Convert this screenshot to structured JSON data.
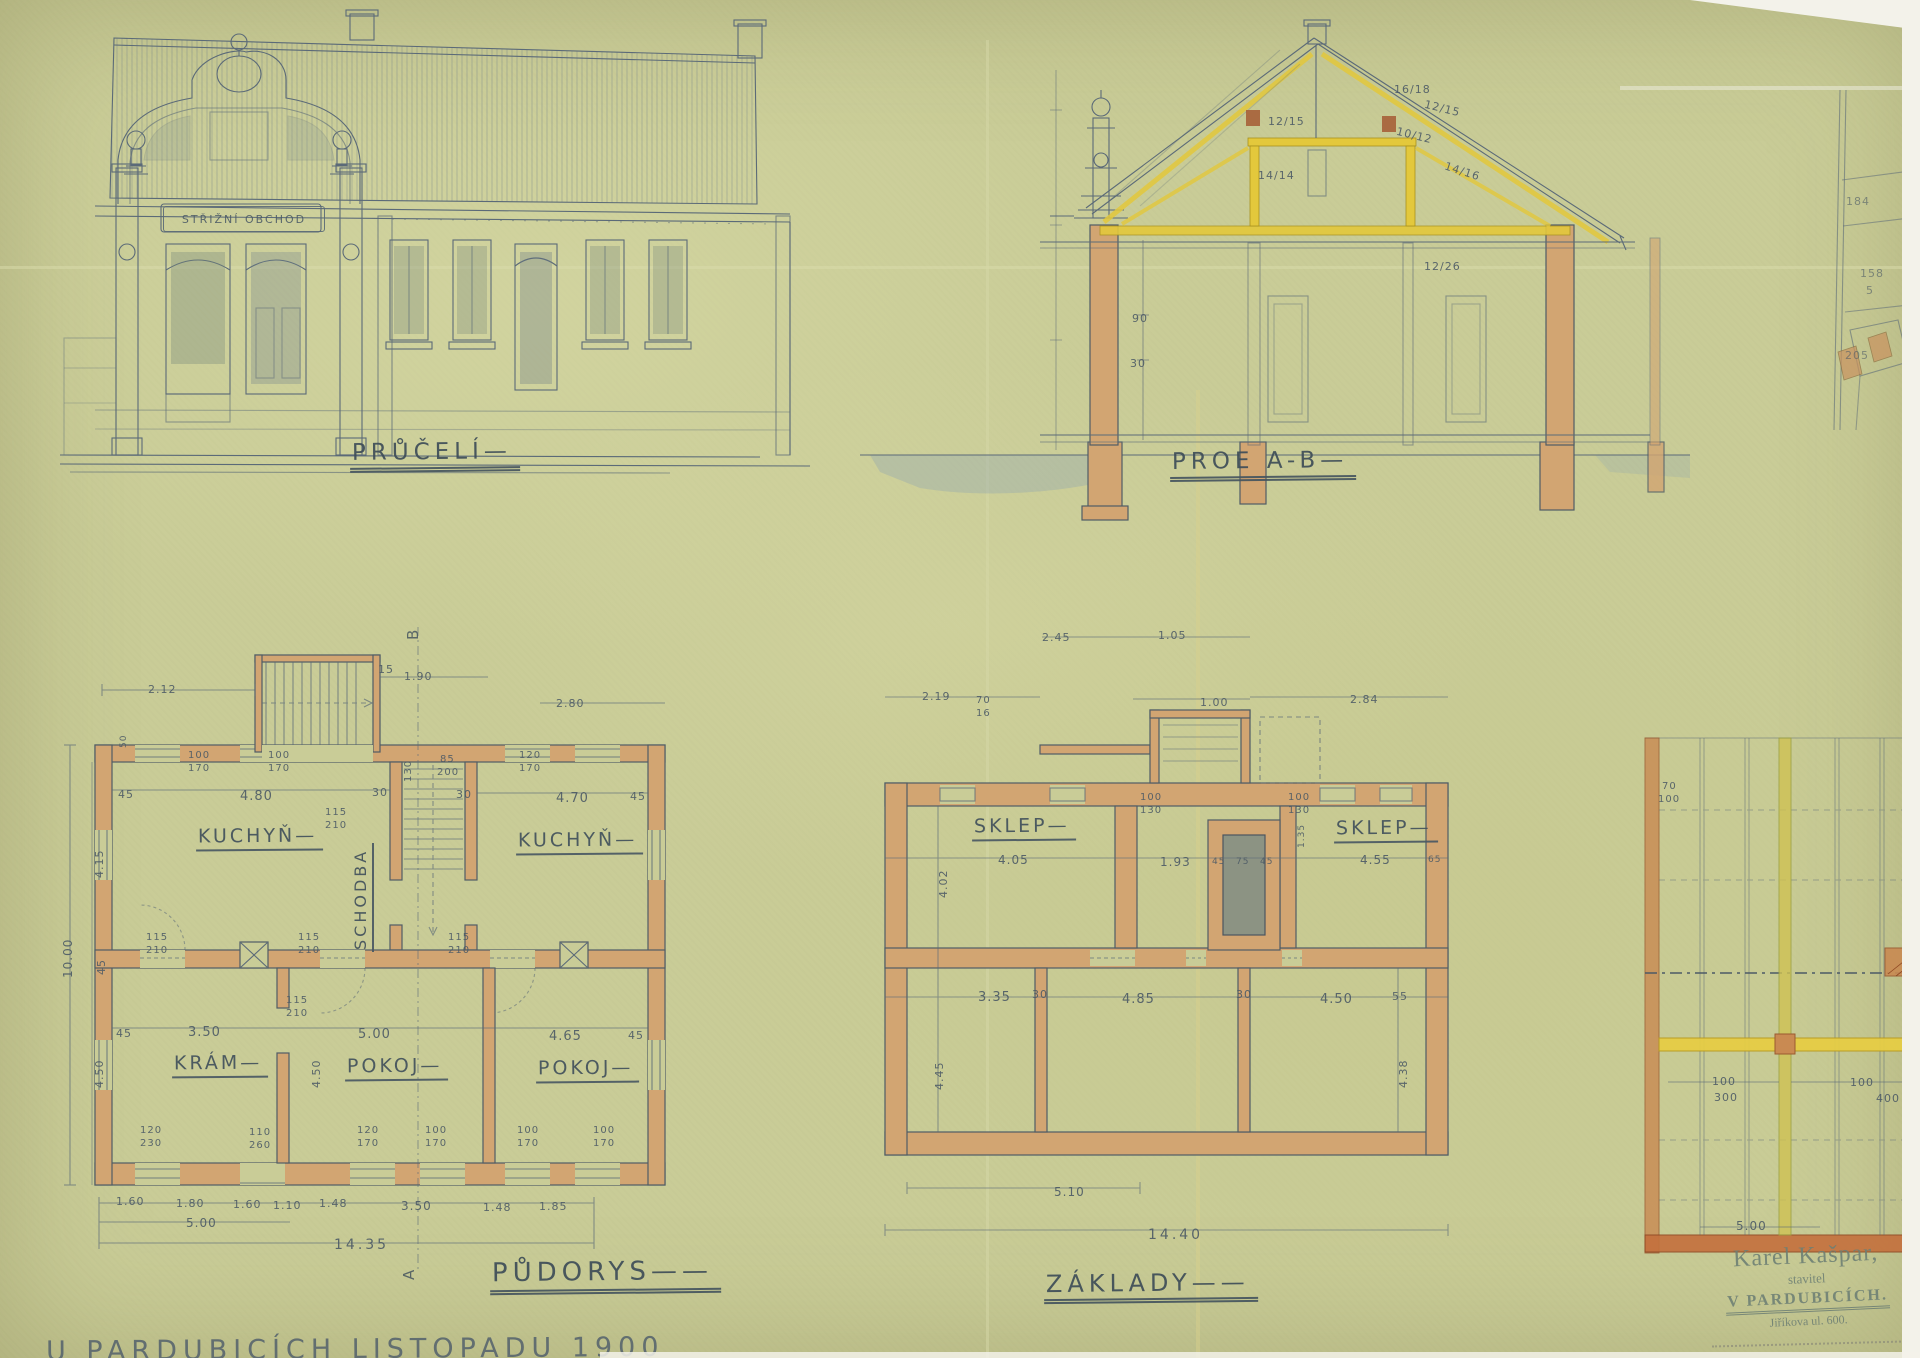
{
  "facade": {
    "title": "PRŮČELÍ—",
    "sign": "STŘIŽNÍ OBCHOD"
  },
  "section": {
    "title": "PROE A-B—",
    "dims": [
      "16/18",
      "12/15",
      "12/15",
      "14/14",
      "10/12",
      "14/16",
      "12/26",
      "90",
      "30"
    ]
  },
  "floor_plan": {
    "title": "PŮDORYS——",
    "marker_top": "B",
    "marker_bottom": "A",
    "rooms": [
      "KUCHYŇ—",
      "SCHODBA",
      "KUCHYŇ—",
      "KRÁM—",
      "POKOJ—",
      "POKOJ—"
    ],
    "dims": [
      "2.12",
      "15",
      "1.90",
      "30",
      "4.80",
      "30",
      "4.70",
      "45",
      "45",
      "85",
      "200",
      "115",
      "210",
      "115",
      "210",
      "115",
      "210",
      "115",
      "210",
      "3.50",
      "5.00",
      "4.65",
      "45",
      "45",
      "1.60",
      "1.80",
      "1.60",
      "1.10",
      "1.48",
      "3.50",
      "1.48",
      "1.85",
      "5.00",
      "14.35",
      "10.00",
      "4.15",
      "4.50",
      "45",
      "2.80",
      "100",
      "170",
      "100",
      "170",
      "120",
      "170",
      "130",
      "115",
      "210",
      "120",
      "230",
      "110",
      "260",
      "120",
      "170",
      "100",
      "170",
      "100",
      "170",
      "100",
      "170",
      "4.50",
      "50"
    ]
  },
  "foundation": {
    "title": "ZÁKLADY——",
    "rooms": [
      "SKLEP—",
      "SKLEP—"
    ],
    "dims": [
      "2.45",
      "1.05",
      "2.19",
      "70",
      "16",
      "1.00",
      "2.84",
      "100",
      "130",
      "100",
      "130",
      "4.05",
      "1.93",
      "45",
      "75",
      "45",
      "4.55",
      "65",
      "3.35",
      "30",
      "4.85",
      "30",
      "4.50",
      "55",
      "5.10",
      "14.40",
      "4.02",
      "4.45",
      "4.38",
      "1.35"
    ]
  },
  "ceiling_plan": {
    "dims": [
      "70",
      "100",
      "100",
      "300",
      "100",
      "400",
      "5.00"
    ]
  },
  "site_plan": {
    "parcels": [
      "184",
      "158",
      "5",
      "205"
    ]
  },
  "stamp": {
    "line1": "Karel Kašpar,",
    "line2": "stavitel",
    "line3": "V PARDUBICÍCH.",
    "line4": "Jiříkova ul. 600."
  },
  "footer": {
    "note": "U PARDUBICÍCH   LISTOPADU 1900"
  },
  "colors": {
    "paper": "#c9cc97",
    "ink": "#55646f",
    "wash_tan": "#d2a572",
    "wash_yellow": "#e3c83c"
  }
}
